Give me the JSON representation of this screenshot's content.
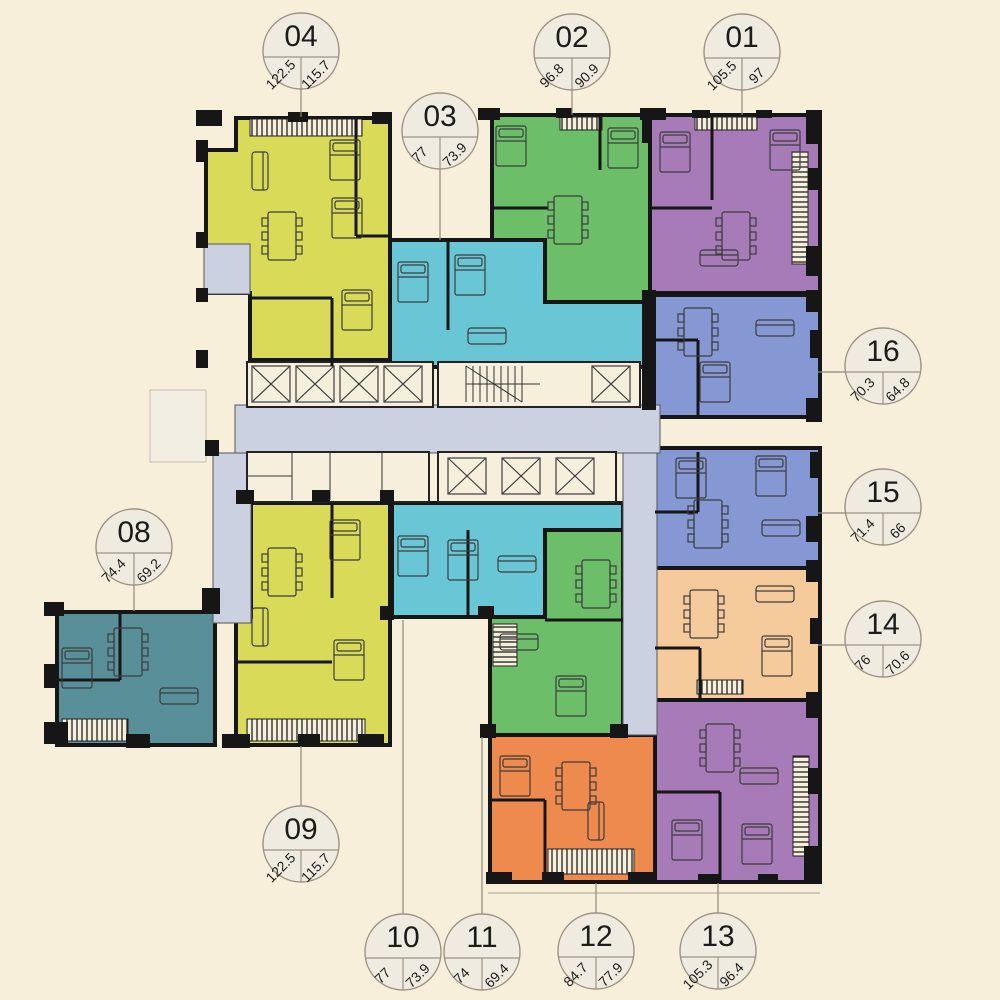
{
  "plan": {
    "title": "floor-plan",
    "background_color": "#f8efda",
    "corridor_color": "#cbd1e1",
    "core_color": "#f6efdc",
    "wall_color": "#161616",
    "callout_fill": "#f0ebe0",
    "callout_stroke": "#9c9383"
  },
  "units": [
    {
      "id": "01",
      "area_total": "105.5",
      "area_net": "97",
      "color": "#a77bb7"
    },
    {
      "id": "02",
      "area_total": "96.8",
      "area_net": "90.9",
      "color": "#6cbf68"
    },
    {
      "id": "03",
      "area_total": "77",
      "area_net": "73.9",
      "color": "#68c6d5"
    },
    {
      "id": "04",
      "area_total": "122.5",
      "area_net": "115.7",
      "color": "#d8da58"
    },
    {
      "id": "08",
      "area_total": "74.4",
      "area_net": "69.2",
      "color": "#588f99"
    },
    {
      "id": "09",
      "area_total": "122.5",
      "area_net": "115.7",
      "color": "#d8da58"
    },
    {
      "id": "10",
      "area_total": "77",
      "area_net": "73.9",
      "color": "#68c6d5"
    },
    {
      "id": "11",
      "area_total": "74",
      "area_net": "69.4",
      "color": "#6cbf68"
    },
    {
      "id": "12",
      "area_total": "84.7",
      "area_net": "77.9",
      "color": "#ee8a4d"
    },
    {
      "id": "13",
      "area_total": "105.3",
      "area_net": "96.4",
      "color": "#a77bb7"
    },
    {
      "id": "14",
      "area_total": "76",
      "area_net": "70.6",
      "color": "#f5cb9c"
    },
    {
      "id": "15",
      "area_total": "71.4",
      "area_net": "66",
      "color": "#8598d4"
    },
    {
      "id": "16",
      "area_total": "70.3",
      "area_net": "64.8",
      "color": "#8598d4"
    }
  ]
}
